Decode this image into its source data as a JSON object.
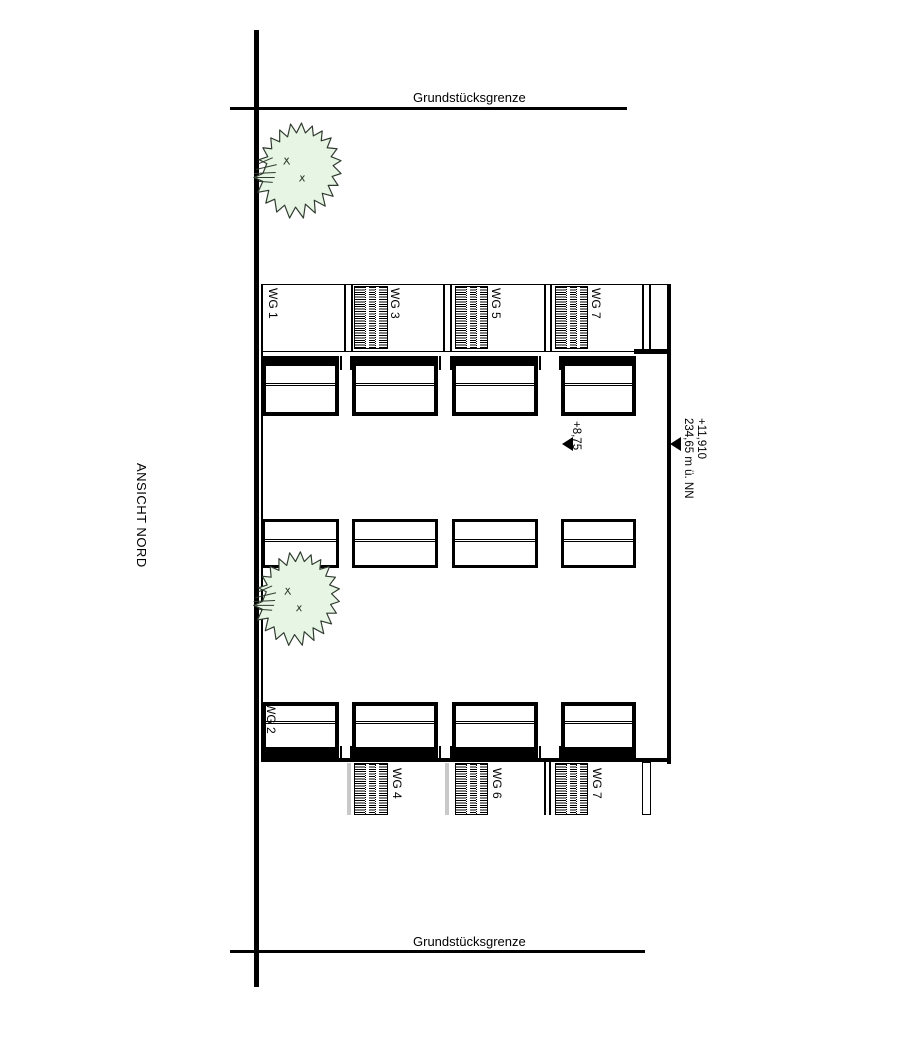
{
  "drawing": {
    "view_label": "ANSICHT NORD",
    "boundary": {
      "top_label": "Grundstücksgrenze",
      "bottom_label": "Grundstücksgrenze"
    },
    "units_top": [
      {
        "label": "WG 1"
      },
      {
        "label": "WG 3"
      },
      {
        "label": "WG 5"
      },
      {
        "label": "WG 7"
      }
    ],
    "units_bottom": [
      {
        "label": "WG 2"
      },
      {
        "label": "WG 4"
      },
      {
        "label": "WG 6"
      },
      {
        "label": "WG 7"
      }
    ],
    "elevations": {
      "attic": {
        "value": "+8,75"
      },
      "ridge": {
        "value": "+11,910",
        "datum": "234,65 m ü. NN"
      }
    },
    "colors": {
      "line": "#000000",
      "tree_fill": "#e7f5e4",
      "tree_stroke": "#2f3b2f",
      "gray_strip": "#c9c9c9"
    }
  }
}
